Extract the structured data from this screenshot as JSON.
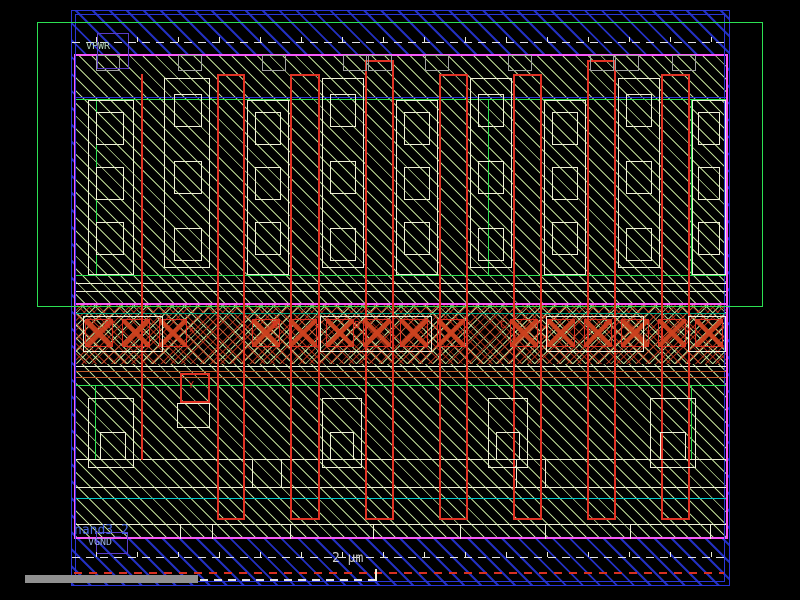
{
  "labels": {
    "top_power": "VPWR",
    "bottom_ground": "VGND",
    "cell_name": "nand3_2",
    "scale": "2 µm"
  },
  "colors": {
    "white": "#f0f0d8",
    "red": "#e03224",
    "green": "#2ce052",
    "magenta": "#f858f8",
    "cyan": "#00c8c8",
    "blue": "#2a35d8",
    "teal": "#00a884",
    "orange": "#c05a28",
    "gray": "#a0a0a0",
    "scrollbar": "#909090",
    "purple": "#5a3cc8",
    "label_text": "#b8d8c0",
    "vgnd_text": "#9ab0e8",
    "cellname_text": "#4868e0",
    "scale_text": "#d0d0d0",
    "pin_text": "#e03224"
  },
  "geometry": {
    "rects": [
      [
        75,
        14,
        650,
        568,
        "blue",
        "o1"
      ],
      [
        37,
        22,
        726,
        285,
        "green",
        "o1"
      ],
      [
        76,
        97,
        650,
        1,
        "blue",
        "f"
      ],
      [
        76,
        99,
        650,
        1,
        "green",
        "f"
      ],
      [
        76,
        275,
        650,
        1,
        "green",
        "f"
      ],
      [
        76,
        283,
        650,
        1,
        "white",
        "f"
      ],
      [
        76,
        291,
        650,
        1,
        "white",
        "f"
      ],
      [
        76,
        303,
        650,
        2,
        "magenta",
        "f"
      ],
      [
        76,
        313,
        650,
        1,
        "teal",
        "f"
      ],
      [
        76,
        366,
        650,
        1,
        "white",
        "f"
      ],
      [
        76,
        371,
        650,
        1,
        "orange",
        "f"
      ],
      [
        76,
        377,
        650,
        1,
        "orange",
        "f"
      ],
      [
        76,
        385,
        650,
        1,
        "green",
        "f"
      ],
      [
        76,
        459,
        650,
        1,
        "white",
        "f"
      ],
      [
        76,
        487,
        650,
        1,
        "white",
        "f"
      ],
      [
        76,
        498,
        650,
        1,
        "cyan",
        "f"
      ],
      [
        76,
        524,
        650,
        1,
        "white",
        "f"
      ],
      [
        96,
        99,
        1,
        176,
        "green",
        "f"
      ],
      [
        440,
        99,
        1,
        176,
        "green",
        "f"
      ],
      [
        488,
        99,
        1,
        176,
        "green",
        "f"
      ],
      [
        691,
        99,
        1,
        176,
        "green",
        "f"
      ],
      [
        95,
        385,
        1,
        74,
        "green",
        "f"
      ],
      [
        440,
        385,
        1,
        74,
        "green",
        "f"
      ],
      [
        691,
        385,
        1,
        74,
        "green",
        "f"
      ],
      [
        141,
        74,
        2,
        386,
        "red",
        "f"
      ],
      [
        217,
        74,
        2,
        446,
        "red",
        "f"
      ],
      [
        243,
        74,
        2,
        446,
        "red",
        "f"
      ],
      [
        290,
        74,
        2,
        446,
        "red",
        "f"
      ],
      [
        318,
        74,
        2,
        446,
        "red",
        "f"
      ],
      [
        365,
        60,
        2,
        460,
        "red",
        "f"
      ],
      [
        392,
        60,
        2,
        460,
        "red",
        "f"
      ],
      [
        439,
        74,
        2,
        446,
        "red",
        "f"
      ],
      [
        466,
        74,
        2,
        446,
        "red",
        "f"
      ],
      [
        513,
        74,
        2,
        446,
        "red",
        "f"
      ],
      [
        540,
        74,
        2,
        446,
        "red",
        "f"
      ],
      [
        587,
        60,
        2,
        460,
        "red",
        "f"
      ],
      [
        614,
        60,
        2,
        460,
        "red",
        "f"
      ],
      [
        661,
        74,
        2,
        446,
        "red",
        "f"
      ],
      [
        688,
        74,
        2,
        446,
        "red",
        "f"
      ],
      [
        217,
        74,
        28,
        2,
        "red",
        "f"
      ],
      [
        290,
        74,
        30,
        2,
        "red",
        "f"
      ],
      [
        365,
        60,
        29,
        2,
        "red",
        "f"
      ],
      [
        439,
        74,
        29,
        2,
        "red",
        "f"
      ],
      [
        513,
        74,
        29,
        2,
        "red",
        "f"
      ],
      [
        587,
        60,
        29,
        2,
        "red",
        "f"
      ],
      [
        661,
        74,
        29,
        2,
        "red",
        "f"
      ],
      [
        217,
        518,
        28,
        2,
        "red",
        "f"
      ],
      [
        290,
        518,
        30,
        2,
        "red",
        "f"
      ],
      [
        365,
        518,
        29,
        2,
        "red",
        "f"
      ],
      [
        439,
        518,
        29,
        2,
        "red",
        "f"
      ],
      [
        513,
        518,
        29,
        2,
        "red",
        "f"
      ],
      [
        587,
        518,
        29,
        2,
        "red",
        "f"
      ],
      [
        661,
        518,
        29,
        2,
        "red",
        "f"
      ],
      [
        180,
        373,
        30,
        30,
        "red",
        "o2"
      ],
      [
        88,
        100,
        46,
        175,
        "white",
        "o1"
      ],
      [
        96,
        112,
        28,
        33,
        "white",
        "o1"
      ],
      [
        96,
        167,
        28,
        33,
        "white",
        "o1"
      ],
      [
        96,
        222,
        28,
        33,
        "white",
        "o1"
      ],
      [
        164,
        78,
        46,
        190,
        "white",
        "o1"
      ],
      [
        174,
        94,
        28,
        33,
        "white",
        "o1"
      ],
      [
        174,
        161,
        28,
        33,
        "white",
        "o1"
      ],
      [
        174,
        228,
        28,
        33,
        "white",
        "o1"
      ],
      [
        247,
        100,
        42,
        175,
        "white",
        "o1"
      ],
      [
        255,
        112,
        26,
        33,
        "white",
        "o1"
      ],
      [
        255,
        167,
        26,
        33,
        "white",
        "o1"
      ],
      [
        255,
        222,
        26,
        33,
        "white",
        "o1"
      ],
      [
        322,
        78,
        42,
        190,
        "white",
        "o1"
      ],
      [
        330,
        94,
        26,
        33,
        "white",
        "o1"
      ],
      [
        330,
        161,
        26,
        33,
        "white",
        "o1"
      ],
      [
        330,
        228,
        26,
        33,
        "white",
        "o1"
      ],
      [
        396,
        100,
        42,
        175,
        "white",
        "o1"
      ],
      [
        404,
        112,
        26,
        33,
        "white",
        "o1"
      ],
      [
        404,
        167,
        26,
        33,
        "white",
        "o1"
      ],
      [
        404,
        222,
        26,
        33,
        "white",
        "o1"
      ],
      [
        470,
        78,
        42,
        190,
        "white",
        "o1"
      ],
      [
        478,
        94,
        26,
        33,
        "white",
        "o1"
      ],
      [
        478,
        161,
        26,
        33,
        "white",
        "o1"
      ],
      [
        478,
        228,
        26,
        33,
        "white",
        "o1"
      ],
      [
        544,
        100,
        42,
        175,
        "white",
        "o1"
      ],
      [
        552,
        112,
        26,
        33,
        "white",
        "o1"
      ],
      [
        552,
        167,
        26,
        33,
        "white",
        "o1"
      ],
      [
        552,
        222,
        26,
        33,
        "white",
        "o1"
      ],
      [
        618,
        78,
        42,
        190,
        "white",
        "o1"
      ],
      [
        626,
        94,
        26,
        33,
        "white",
        "o1"
      ],
      [
        626,
        161,
        26,
        33,
        "white",
        "o1"
      ],
      [
        626,
        228,
        26,
        33,
        "white",
        "o1"
      ],
      [
        692,
        100,
        34,
        175,
        "white",
        "o1"
      ],
      [
        698,
        112,
        22,
        33,
        "white",
        "o1"
      ],
      [
        698,
        167,
        22,
        33,
        "white",
        "o1"
      ],
      [
        698,
        222,
        22,
        33,
        "white",
        "o1"
      ],
      [
        88,
        398,
        46,
        70,
        "white",
        "o1"
      ],
      [
        100,
        432,
        26,
        28,
        "white",
        "o1"
      ],
      [
        177,
        403,
        33,
        25,
        "white",
        "o1"
      ],
      [
        322,
        398,
        40,
        70,
        "white",
        "o1"
      ],
      [
        330,
        432,
        24,
        28,
        "white",
        "o1"
      ],
      [
        488,
        398,
        40,
        70,
        "white",
        "o1"
      ],
      [
        496,
        432,
        24,
        28,
        "white",
        "o1"
      ],
      [
        650,
        398,
        46,
        70,
        "white",
        "o1"
      ],
      [
        660,
        432,
        26,
        28,
        "white",
        "o1"
      ],
      [
        252,
        459,
        1,
        28,
        "white",
        "f"
      ],
      [
        281,
        459,
        1,
        28,
        "white",
        "f"
      ],
      [
        516,
        459,
        1,
        28,
        "white",
        "f"
      ],
      [
        545,
        459,
        1,
        28,
        "white",
        "f"
      ],
      [
        85,
        319,
        28,
        28,
        "red",
        "x"
      ],
      [
        122,
        319,
        28,
        28,
        "red",
        "x"
      ],
      [
        159,
        319,
        28,
        28,
        "red",
        "x"
      ],
      [
        252,
        319,
        28,
        28,
        "red",
        "x"
      ],
      [
        289,
        319,
        28,
        28,
        "red",
        "x"
      ],
      [
        326,
        319,
        28,
        28,
        "red",
        "x"
      ],
      [
        363,
        319,
        28,
        28,
        "red",
        "x"
      ],
      [
        400,
        319,
        28,
        28,
        "red",
        "x"
      ],
      [
        437,
        319,
        28,
        28,
        "red",
        "x"
      ],
      [
        510,
        319,
        28,
        28,
        "red",
        "x"
      ],
      [
        547,
        319,
        28,
        28,
        "red",
        "x"
      ],
      [
        584,
        319,
        28,
        28,
        "red",
        "x"
      ],
      [
        621,
        319,
        28,
        28,
        "red",
        "x"
      ],
      [
        658,
        319,
        28,
        28,
        "red",
        "x"
      ],
      [
        695,
        319,
        28,
        28,
        "red",
        "x"
      ],
      [
        83,
        316,
        80,
        36,
        "white",
        "o1"
      ],
      [
        320,
        316,
        112,
        36,
        "white",
        "o1"
      ],
      [
        546,
        316,
        98,
        36,
        "white",
        "o1"
      ],
      [
        688,
        316,
        38,
        36,
        "white",
        "o1"
      ],
      [
        96,
        55,
        24,
        16,
        "gray",
        "o1"
      ],
      [
        178,
        55,
        24,
        16,
        "gray",
        "o1"
      ],
      [
        262,
        55,
        24,
        16,
        "gray",
        "o1"
      ],
      [
        343,
        55,
        24,
        16,
        "gray",
        "o1"
      ],
      [
        368,
        55,
        24,
        16,
        "gray",
        "o1"
      ],
      [
        425,
        55,
        24,
        16,
        "gray",
        "o1"
      ],
      [
        508,
        55,
        24,
        16,
        "gray",
        "o1"
      ],
      [
        590,
        55,
        24,
        16,
        "gray",
        "o1"
      ],
      [
        615,
        55,
        24,
        16,
        "gray",
        "o1"
      ],
      [
        672,
        55,
        24,
        16,
        "gray",
        "o1"
      ],
      [
        180,
        524,
        1,
        15,
        "white",
        "f"
      ],
      [
        212,
        524,
        1,
        15,
        "white",
        "f"
      ],
      [
        290,
        524,
        1,
        15,
        "white",
        "f"
      ],
      [
        373,
        524,
        1,
        15,
        "white",
        "f"
      ],
      [
        460,
        524,
        1,
        15,
        "white",
        "f"
      ],
      [
        545,
        524,
        1,
        15,
        "white",
        "f"
      ],
      [
        630,
        524,
        1,
        15,
        "white",
        "f"
      ],
      [
        710,
        524,
        1,
        15,
        "white",
        "f"
      ],
      [
        97,
        33,
        32,
        36,
        "purple",
        "o1"
      ],
      [
        96,
        532,
        32,
        22,
        "purple",
        "o1"
      ],
      [
        72,
        42,
        658,
        1,
        "white",
        "dw"
      ],
      [
        72,
        557,
        658,
        1,
        "white",
        "dw"
      ],
      [
        74,
        572,
        650,
        2,
        "red",
        "dr"
      ],
      [
        200,
        579,
        177,
        2,
        "white",
        "dw"
      ],
      [
        375,
        569,
        2,
        12,
        "white",
        "f"
      ],
      [
        25,
        575,
        173,
        8,
        "scrollbar",
        "f"
      ]
    ],
    "pin_labels": [
      [
        104,
        321,
        "A",
        "pin_text",
        10
      ],
      [
        189,
        326,
        "x",
        "pin_text",
        9
      ],
      [
        272,
        321,
        "B",
        "pin_text",
        10
      ],
      [
        354,
        321,
        "B",
        "pin_text",
        10
      ],
      [
        500,
        321,
        "C",
        "pin_text",
        10
      ],
      [
        603,
        321,
        "C",
        "pin_text",
        10
      ],
      [
        686,
        326,
        "x",
        "pin_text",
        9
      ],
      [
        188,
        381,
        "Y",
        "pin_text",
        10
      ]
    ],
    "ruler_ticks": {
      "x_start": 96,
      "step": 41,
      "count": 16,
      "rows": [
        {
          "y": 37,
          "h": 5
        },
        {
          "y": 552,
          "h": 5
        }
      ]
    }
  }
}
